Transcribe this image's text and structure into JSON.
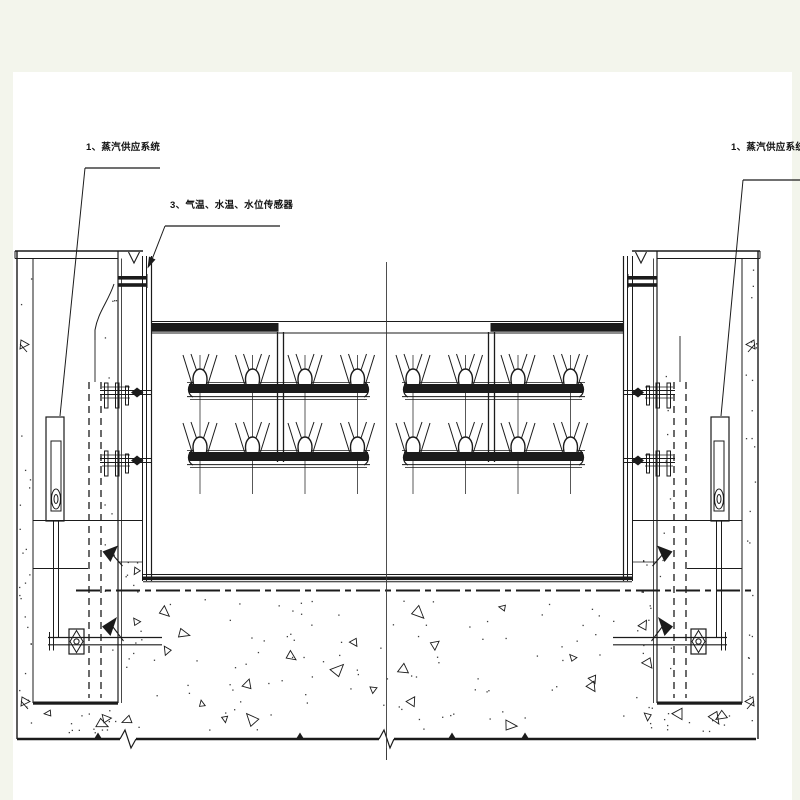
{
  "page": {
    "background_color": "#f3f5ec",
    "paper_color": "#ffffff",
    "line_color": "#1b1b1b"
  },
  "labels": {
    "steam_supply_left": "1、蒸汽供应系统",
    "sensors": "3、气温、水温、水位传感器",
    "steam_supply_right": "1、蒸汽供应系统"
  },
  "drawing": {
    "sprayer_groups": 2,
    "rows_per_group": 2,
    "sprayers_per_row": 4,
    "total_sprayers": 16
  }
}
